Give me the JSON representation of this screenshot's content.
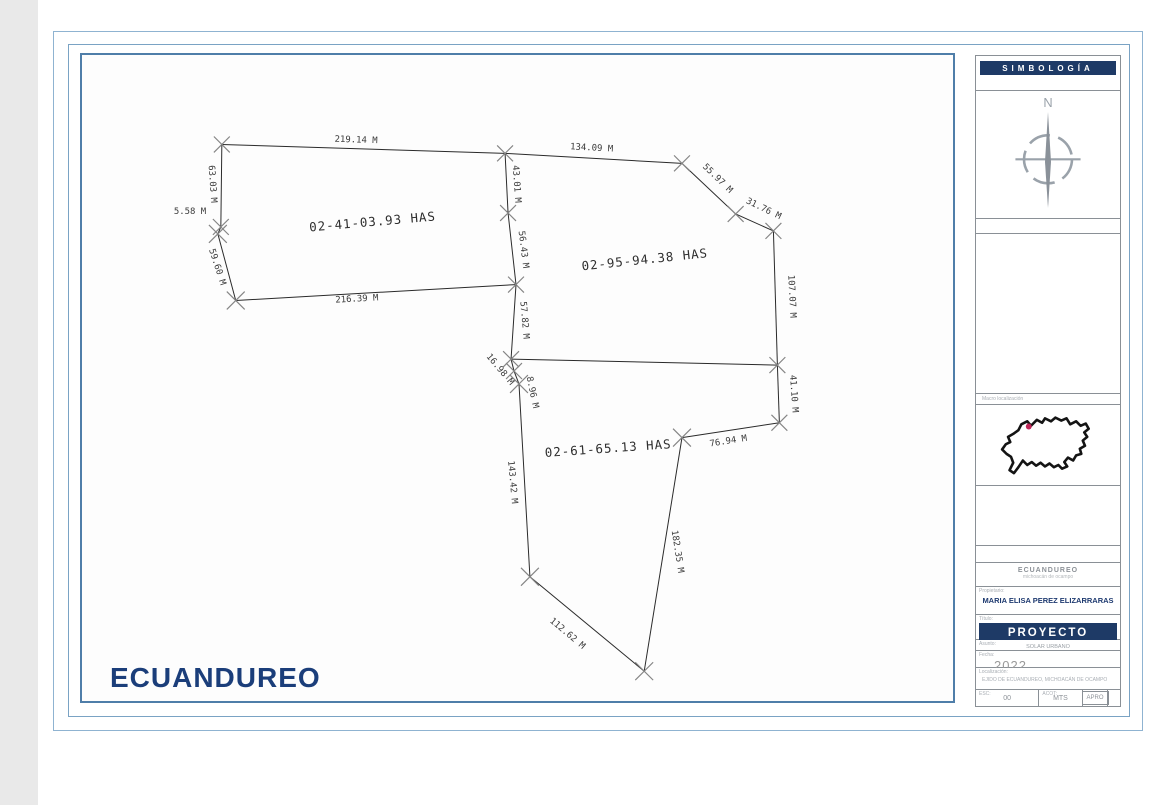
{
  "frame": {
    "title": "ECUANDUREO"
  },
  "sidebar": {
    "symbology": "SIMBOLOGÍA",
    "compass_north": "N",
    "map_caption": "Macro localización",
    "title_block": {
      "org_name": "ECUANDUREO",
      "org_subtitle": "michoacán de ocampo",
      "owner_label": "Propietario:",
      "owner": "MARIA ELISA PEREZ ELIZARRARAS",
      "title_label": "Título:",
      "project": "PROYECTO",
      "subject_label": "Asunto:",
      "subject": "SOLAR URBANO",
      "date_label": "Fecha:",
      "year": "2022",
      "location_label": "Localización:",
      "location": "EJIDO DE ECUANDUREO, MICHOACÁN DE OCAMPO",
      "scale_label": "ESC:",
      "scale": "00",
      "units_label": "ACOT:",
      "units": "MTS",
      "approval": "APRO"
    }
  },
  "drawing": {
    "parcels": [
      {
        "area": "02-41-03.93 HAS"
      },
      {
        "area": "02-95-94.38 HAS"
      },
      {
        "area": "02-61-65.13 HAS"
      }
    ],
    "measurements": [
      "219.14 M",
      "134.09 M",
      "55.97 M",
      "31.76 M",
      "107.07 M",
      "41.10 M",
      "76.94 M",
      "182.35 M",
      "112.62 M",
      "143.42 M",
      "8.96 M",
      "16.98 M",
      "57.82 M",
      "56.43 M",
      "43.01 M",
      "63.03 M",
      "5.58 M",
      "59.60 M",
      "216.39 M"
    ],
    "colors": {
      "accent_navy": "#1e3a66",
      "frame_blue": "#4f7ea9",
      "marker_red": "#c0285a"
    }
  }
}
